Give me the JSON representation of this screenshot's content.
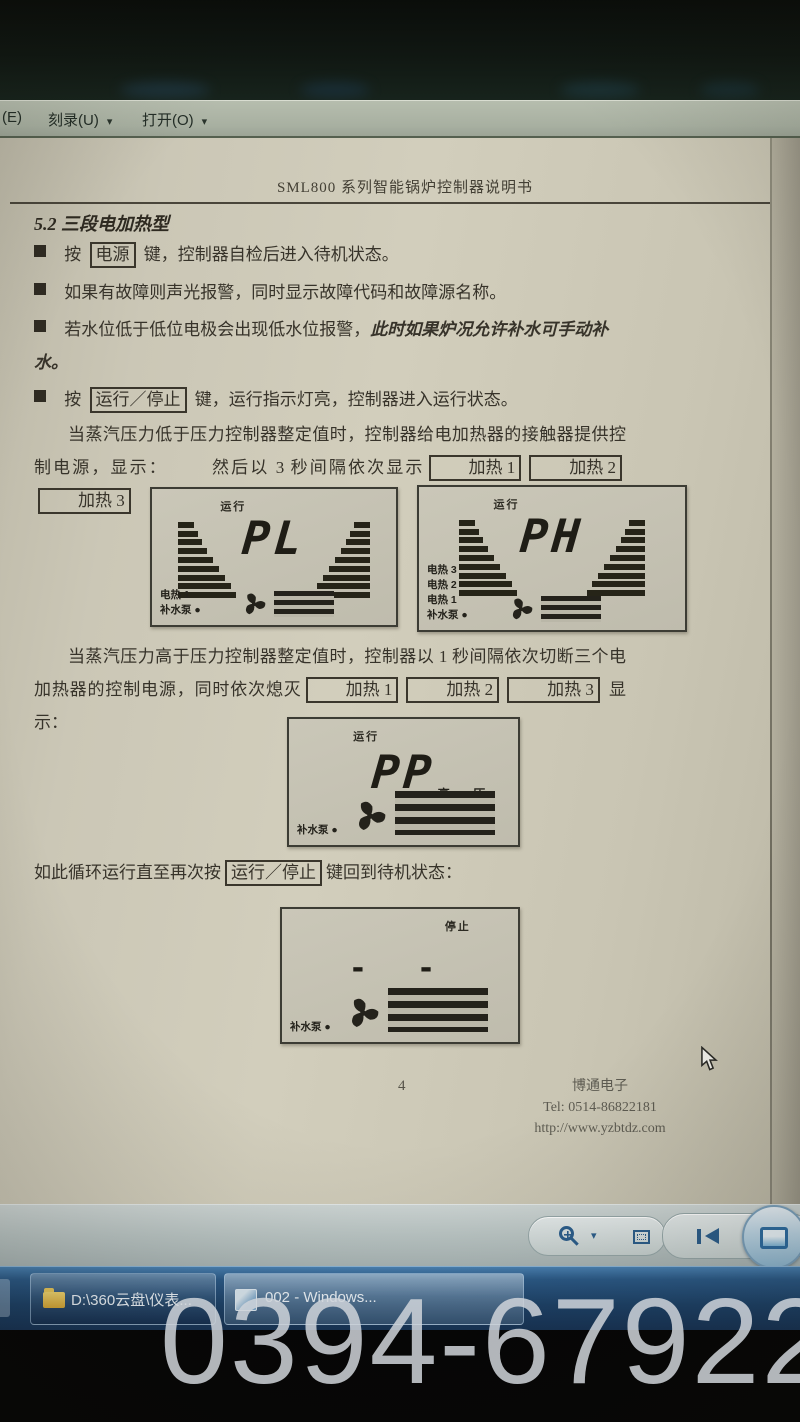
{
  "glyphs": {
    "bullet": "■",
    "caret": "▾"
  },
  "menu_bar": {
    "partial_label": "(E)",
    "items": [
      {
        "label": "刻录(U)"
      },
      {
        "label": "打开(O)"
      }
    ]
  },
  "document": {
    "title": "SML800 系列智能锅炉控制器说明书",
    "heading": "5.2 三段电加热型",
    "bullets": {
      "b1": {
        "pre": "按",
        "key": "电源",
        "post": "键，控制器自检后进入待机状态。"
      },
      "b2": {
        "text": "如果有故障则声光报警，同时显示故障代码和故障源名称。"
      },
      "b3": {
        "text": "若水位低于低位电极会出现低水位报警，",
        "italic": "此时如果炉况允许补水可手动补水。"
      },
      "b4": {
        "pre": "按",
        "key": "运行／停止",
        "post": "键，运行指示灯亮，控制器进入运行状态。"
      }
    },
    "para_low": {
      "t1": "当蒸汽压力低于压力控制器整定值时，控制器给电加热器的接触器提供控制电源，显示：",
      "t2": "然后以 3 秒间隔依次显示",
      "k1": "加热 1",
      "k2": "加热 2",
      "k3": "加热 3"
    },
    "para_high": {
      "t1": "当蒸汽压力高于压力控制器整定值时，控制器以 1 秒间隔依次切断三个电加热器的控制电源，同时依次熄灭",
      "k1": "加热 1",
      "k2": "加热 2",
      "k3": "加热 3",
      "t2": "显示："
    },
    "para_loop": {
      "t1": "如此循环运行直至再次按",
      "key": "运行／停止",
      "t2": "键回到待机状态："
    },
    "panels": [
      {
        "status": "运行",
        "value": "PL",
        "labels": [
          "电热 1",
          "补水泵 ●"
        ]
      },
      {
        "status": "运行",
        "value": "PH",
        "labels": [
          "电热 3",
          "电热 2",
          "电热 1",
          "补水泵 ●"
        ]
      },
      {
        "status": "运行",
        "value": "PP",
        "side_label": "高 压",
        "labels": [
          "补水泵 ●"
        ]
      },
      {
        "status": "停止",
        "value": "- -",
        "labels": [
          "补水泵 ●"
        ]
      }
    ],
    "footer": {
      "page": "4",
      "company": "博通电子",
      "tel": "Tel: 0514-86822181",
      "url": "http://www.yzbtdz.com"
    }
  },
  "viewer_toolbar": {
    "icons": [
      "zoom-in-icon",
      "zoom-dropdown-caret-icon",
      "fit-to-window-icon",
      "previous-icon",
      "display-screen-icon"
    ]
  },
  "taskbar": {
    "buttons": [
      {
        "label": "D:\\360云盘\\仪表..."
      },
      {
        "label": "002 - Windows..."
      }
    ]
  },
  "watermark": {
    "text": "0394-6792297"
  },
  "colors": {
    "taskbar_blue": "#1d4269",
    "menu_green": "#a8b0a1",
    "page_beige": "#cbc7b6",
    "icon_blue": "#2c5e8c",
    "watermark_gray": "#d0d5da"
  }
}
